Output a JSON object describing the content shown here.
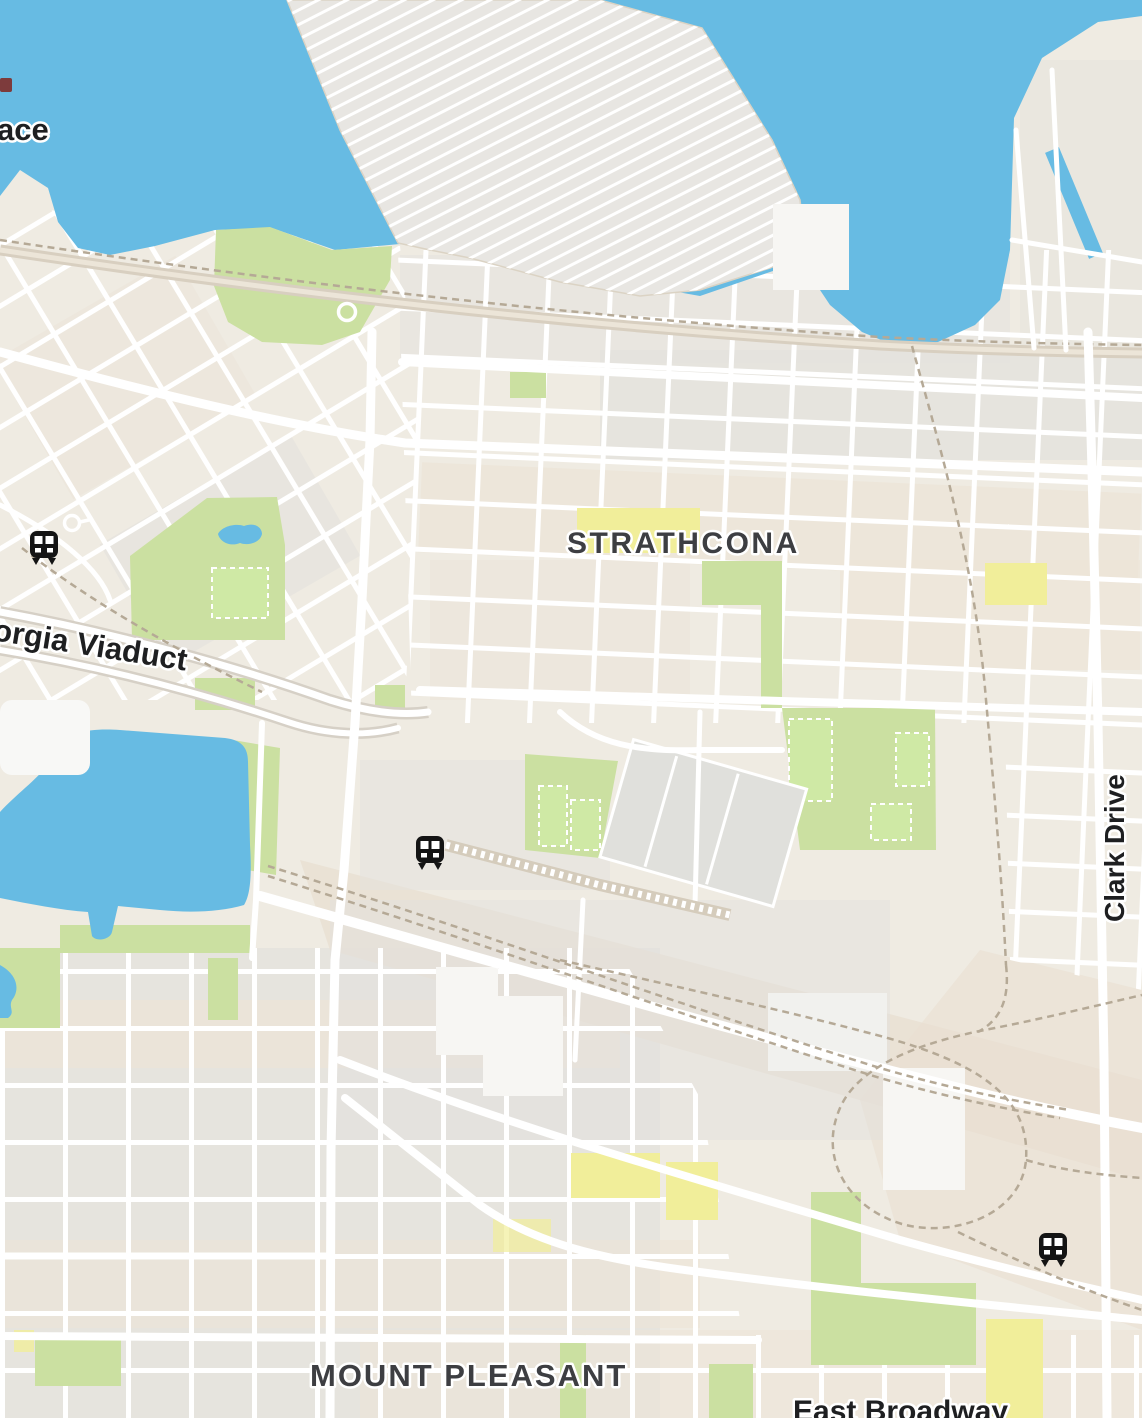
{
  "map": {
    "title": "Vancouver neighbourhood map (Strathcona / Mount Pleasant)",
    "labels": {
      "canada_place_partial": "ace",
      "strathcona": "STRATHCONA",
      "georgia_viaduct": "orgia Viaduct",
      "clark_drive": "Clark Drive",
      "mount_pleasant": "MOUNT PLEASANT",
      "east_broadway": "East Broadway"
    },
    "icons": {
      "transit_station": "train-station-icon",
      "poi_circle": "circle-poi-icon",
      "poi_chip": "poi-marker-fragment"
    },
    "transit_station_count": 3,
    "colors": {
      "land": "#efebe2",
      "water": "#67bbe3",
      "block_grey": "#e3e1dd",
      "block_beige": "#ece4d7",
      "block_beige2": "#e9e0d2",
      "road": "#ffffff",
      "road_tan": "#d8cfc0",
      "rail": "#b5a996",
      "park": "#cbe0a1",
      "field": "#cfe9a5",
      "school": "#f1ee9a",
      "building": "#f7f6f3",
      "pier": "#e8e6e2",
      "label_dark": "#3d3e42",
      "label_black": "#1e1f21",
      "station_icon": "#141414"
    }
  }
}
